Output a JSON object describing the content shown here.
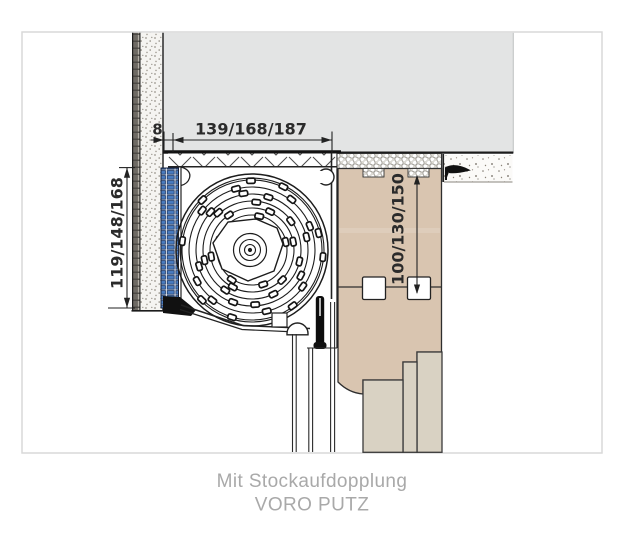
{
  "figure": {
    "dimensions": {
      "top_offset": "8",
      "top_width": "139/168/187",
      "left_height": "119/148/168",
      "right_height": "100/130/150"
    },
    "caption": {
      "line1": "Mit Stockaufdopplung",
      "line2": "VORO PUTZ"
    }
  },
  "colors": {
    "slab_gray": "#e3e4e4",
    "frame_tan": "#d9c5b0",
    "frame_step": "#d9d2c3",
    "insulation_blue": "#4a7cc0",
    "caption_gray": "#a9a9a9",
    "line_dark": "#222222",
    "border_gray": "#d9d9d9"
  }
}
